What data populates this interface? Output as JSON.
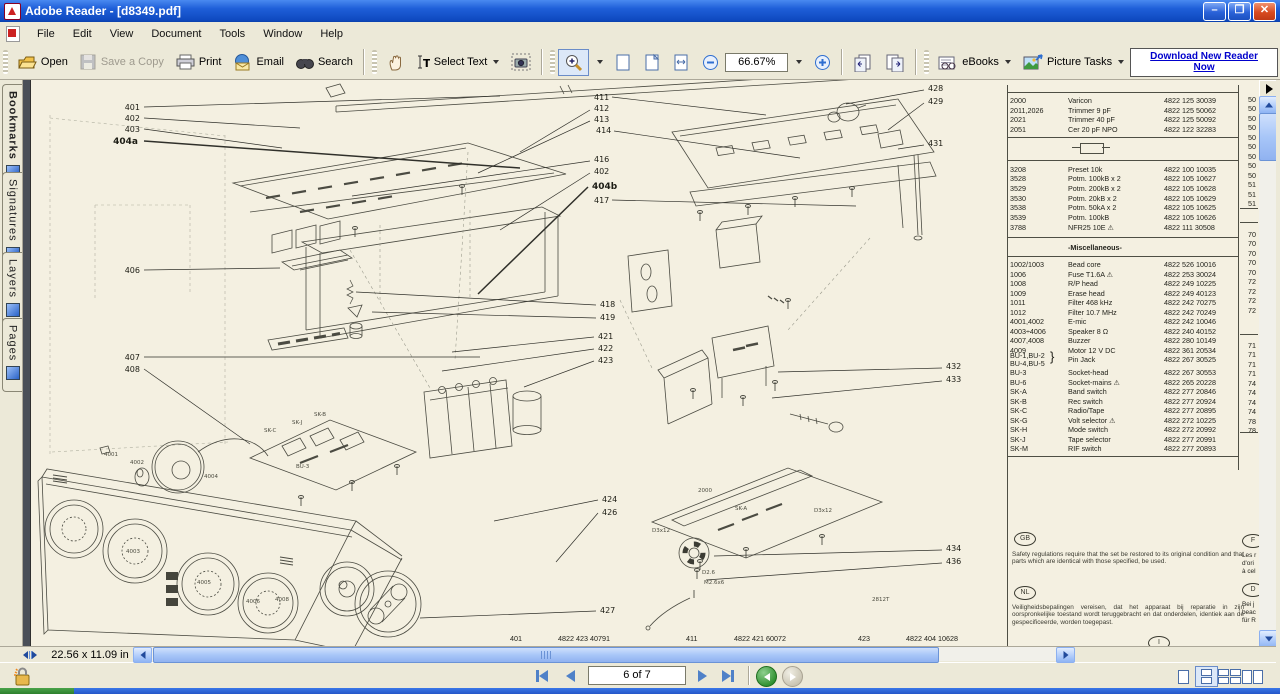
{
  "window": {
    "title": "Adobe Reader - [d8349.pdf]"
  },
  "menu": {
    "items": [
      "File",
      "Edit",
      "View",
      "Document",
      "Tools",
      "Window",
      "Help"
    ]
  },
  "toolbar": {
    "open": "Open",
    "save": "Save a Copy",
    "print": "Print",
    "email": "Email",
    "search": "Search",
    "select_text": "Select Text",
    "zoom_value": "66.67%",
    "ebooks": "eBooks",
    "picture_tasks": "Picture Tasks",
    "download_line1": "Download New Reader",
    "download_line2": "Now"
  },
  "sidebar": {
    "tabs": [
      "Bookmarks",
      "Signatures",
      "Layers",
      "Pages"
    ]
  },
  "statusbar": {
    "page_size": "22.56 x 11.09 in"
  },
  "navbar": {
    "page_field": "6 of 7"
  },
  "page": {
    "table": {
      "section1": [
        [
          "2000",
          "Varicon",
          "4822 125 30039"
        ],
        [
          "2011,2026",
          "Trimmer 9 pF",
          "4822 125 50062"
        ],
        [
          "2021",
          "Trimmer 40 pF",
          "4822 125 50092"
        ],
        [
          "2051",
          "Cer 20 pF NPO",
          "4822 122 32283"
        ]
      ],
      "section2": [
        [
          "3208",
          "Preset 10k",
          "4822 100 10035"
        ],
        [
          "3528",
          "Potm. 100kB x 2",
          "4822 105 10627"
        ],
        [
          "3529",
          "Potm. 200kB x 2",
          "4822 105 10628"
        ],
        [
          "3530",
          "Potm. 20kB x 2",
          "4822 105 10629"
        ],
        [
          "3538",
          "Potm. 50kA x 2",
          "4822 105 10625"
        ],
        [
          "3539",
          "Potm. 100kB",
          "4822 105 10626"
        ],
        [
          "3788",
          "NFR25 10E ⚠",
          "4822 111 30508"
        ]
      ],
      "misc_title": "-Miscellaneous-",
      "misc_rows": [
        [
          "1002/1003",
          "Bead core",
          "4822 526 10016"
        ],
        [
          "1006",
          "Fuse T1.6A ⚠",
          "4822 253 30024"
        ],
        [
          "1008",
          "R/P head",
          "4822 249 10225"
        ],
        [
          "1009",
          "Erase head",
          "4822 249 40123"
        ],
        [
          "1011",
          "Filter 468 kHz",
          "4822 242 70275"
        ],
        [
          "1012",
          "Filter 10.7 MHz",
          "4822 242 70249"
        ],
        [
          "4001,4002",
          "E-mic",
          "4822 242 10046"
        ],
        [
          "4003÷4006",
          "Speaker 8 Ω",
          "4822 240 40152"
        ],
        [
          "4007,4008",
          "Buzzer",
          "4822 280 10149"
        ],
        [
          "4009",
          "Motor 12 V DC",
          "4822 361 20534"
        ]
      ],
      "pin_jack": {
        "ref1": "BU-1,BU-2",
        "ref2": "BU-4,BU-5",
        "brace": "}",
        "desc": "Pin Jack",
        "code": "4822 267 30525"
      },
      "tail_rows": [
        [
          "BU-3",
          "Socket-head",
          "4822 267 30553"
        ],
        [
          "BU-6",
          "Socket-mains ⚠",
          "4822 265 20228"
        ],
        [
          "SK-A",
          "Band switch",
          "4822 277 20846"
        ],
        [
          "SK-B",
          "Rec switch",
          "4822 277 20924"
        ],
        [
          "SK-C",
          "Radio/Tape",
          "4822 277 20895"
        ],
        [
          "SK-G",
          "Volt selector ⚠",
          "4822 272 10225"
        ],
        [
          "SK-H",
          "Mode switch",
          "4822 272 20992"
        ],
        [
          "SK-J",
          "Tape selector",
          "4822 277 20991"
        ],
        [
          "SK-M",
          "RIF switch",
          "4822 277 20893"
        ]
      ],
      "cut_groups": [
        [
          "50",
          "50",
          "50",
          "50",
          "50",
          "50",
          "50",
          "50",
          "50",
          "51",
          "51",
          "51"
        ],
        [
          "70",
          "70",
          "70",
          "70",
          "70",
          "72",
          "72",
          "72",
          "72"
        ],
        [
          "71",
          "71",
          "71",
          "71",
          "74",
          "74",
          "74",
          "74",
          "78",
          "78"
        ]
      ]
    },
    "notes": {
      "gb_label": "GB",
      "gb_text": "Safety regulations require that the set be restored to its original condition and that parts which are identical with those specified, be used.",
      "nl_label": "NL",
      "nl_text": "Veiligheidsbepalingen vereisen, dat het apparaat bij reparatie in zijn oorspronkelijke toestand wordt teruggebracht en dat onderdelen, identiek aan de gespecificeerde, worden toegepast.",
      "f_label": "F",
      "f_lines": [
        "Les r",
        "d'ori",
        "à cel"
      ],
      "d_label": "D",
      "d_lines": [
        "Bei j",
        "beac",
        "für R"
      ],
      "i_label": "I"
    },
    "footer": [
      {
        "ref": "401",
        "code": "4822 423 40791",
        "x": 510
      },
      {
        "ref": "411",
        "code": "4822 421 60072",
        "x": 686
      },
      {
        "ref": "423",
        "code": "4822 404 10628",
        "x": 858
      }
    ],
    "callouts": [
      [
        "401",
        140,
        110,
        "e",
        144,
        107,
        500,
        96,
        0
      ],
      [
        "402",
        140,
        121,
        "e",
        144,
        118,
        300,
        128,
        0
      ],
      [
        "403",
        140,
        132,
        "e",
        144,
        129,
        282,
        148,
        0
      ],
      [
        "404a",
        138,
        144,
        "e",
        144,
        141,
        520,
        168,
        1
      ],
      [
        "406",
        140,
        273,
        "e",
        144,
        270,
        280,
        268,
        0
      ],
      [
        "407",
        140,
        360,
        "e",
        144,
        357,
        480,
        357,
        0
      ],
      [
        "408",
        140,
        372,
        "e",
        144,
        369,
        250,
        444,
        0
      ],
      [
        "411",
        594,
        100,
        "s",
        612,
        97,
        766,
        115,
        0
      ],
      [
        "412",
        594,
        111,
        "s",
        590,
        110,
        520,
        152,
        0
      ],
      [
        "413",
        594,
        122,
        "s",
        590,
        121,
        478,
        173,
        0
      ],
      [
        "414",
        596,
        133,
        "s",
        614,
        131,
        800,
        158,
        0
      ],
      [
        "416",
        594,
        162,
        "s",
        590,
        161,
        352,
        196,
        0
      ],
      [
        "402",
        594,
        174,
        "s",
        590,
        173,
        500,
        230,
        0
      ],
      [
        "404b",
        592,
        189,
        "s",
        588,
        187,
        478,
        294,
        1
      ],
      [
        "417",
        594,
        203,
        "s",
        612,
        200,
        856,
        206,
        0
      ],
      [
        "418",
        600,
        307,
        "s",
        596,
        305,
        356,
        292,
        0
      ],
      [
        "419",
        600,
        320,
        "s",
        596,
        318,
        372,
        312,
        0
      ],
      [
        "421",
        598,
        339,
        "s",
        594,
        337,
        452,
        352,
        0
      ],
      [
        "422",
        598,
        351,
        "s",
        594,
        349,
        442,
        371,
        0
      ],
      [
        "423",
        598,
        363,
        "s",
        594,
        361,
        524,
        387,
        0
      ],
      [
        "424",
        602,
        502,
        "s",
        598,
        500,
        494,
        521,
        0
      ],
      [
        "426",
        602,
        515,
        "s",
        598,
        513,
        556,
        562,
        0
      ],
      [
        "427",
        600,
        613,
        "s",
        596,
        611,
        420,
        618,
        0
      ],
      [
        "428",
        928,
        91,
        "s",
        924,
        90,
        846,
        104,
        0
      ],
      [
        "429",
        928,
        104,
        "s",
        924,
        103,
        888,
        130,
        0
      ],
      [
        "431",
        928,
        146,
        "s",
        924,
        145,
        898,
        149,
        0
      ],
      [
        "432",
        946,
        369,
        "s",
        942,
        368,
        778,
        372,
        0
      ],
      [
        "433",
        946,
        382,
        "s",
        942,
        381,
        772,
        398,
        0
      ],
      [
        "434",
        946,
        551,
        "s",
        942,
        550,
        714,
        556,
        0
      ],
      [
        "436",
        946,
        564,
        "s",
        942,
        563,
        706,
        580,
        0
      ]
    ],
    "micro_labels": [
      [
        "4001",
        104,
        456
      ],
      [
        "4002",
        130,
        464
      ],
      [
        "4004",
        204,
        478
      ],
      [
        "4003",
        126,
        553
      ],
      [
        "4005",
        197,
        584
      ],
      [
        "4006",
        246,
        603
      ],
      [
        "4008",
        275,
        601
      ],
      [
        "2000",
        698,
        492
      ],
      [
        "SK-A",
        735,
        510
      ],
      [
        "SK-C",
        264,
        432
      ],
      [
        "SK-J",
        292,
        424
      ],
      [
        "SK-B",
        314,
        416
      ],
      [
        "BU-3",
        296,
        468
      ],
      [
        "D3x12",
        652,
        532
      ],
      [
        "D3x12",
        814,
        512
      ],
      [
        "D2.6",
        702,
        574
      ],
      [
        "M2.6x6",
        704,
        584
      ],
      [
        "2812T",
        872,
        601
      ]
    ]
  }
}
